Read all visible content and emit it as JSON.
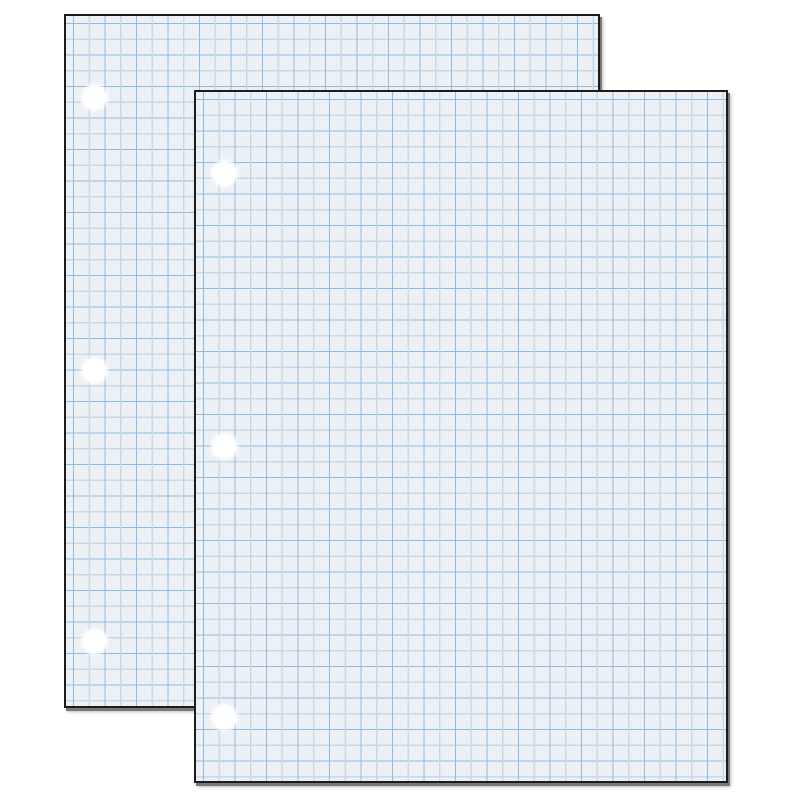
{
  "scene": {
    "subject": "Two overlapping sheets of white quadrille-ruled graph paper with three punched holes each",
    "sheet_count": 2,
    "visible_text": ""
  },
  "colors": {
    "page-bg": "#ffffff",
    "paper-fill": "#eef2f7",
    "grid-line-dark": "#92bcdf",
    "grid-line-light": "#c7dbee",
    "sheet-border": "#1c1c1c",
    "sheet-shadow": "#787878",
    "hole-fill": "#ffffff"
  },
  "paper": {
    "grid_cell_px": 15.75,
    "holes_per_sheet": 3,
    "hole_diameter_px": 23,
    "hole_left_px": 17,
    "hole_top_offsets_px": [
      70,
      343,
      614
    ]
  },
  "sheets": [
    {
      "id": "back",
      "left_px": 64,
      "top_px": 14,
      "width_px": 536,
      "height_px": 694
    },
    {
      "id": "front",
      "left_px": 194,
      "top_px": 90,
      "width_px": 534,
      "height_px": 693
    }
  ]
}
